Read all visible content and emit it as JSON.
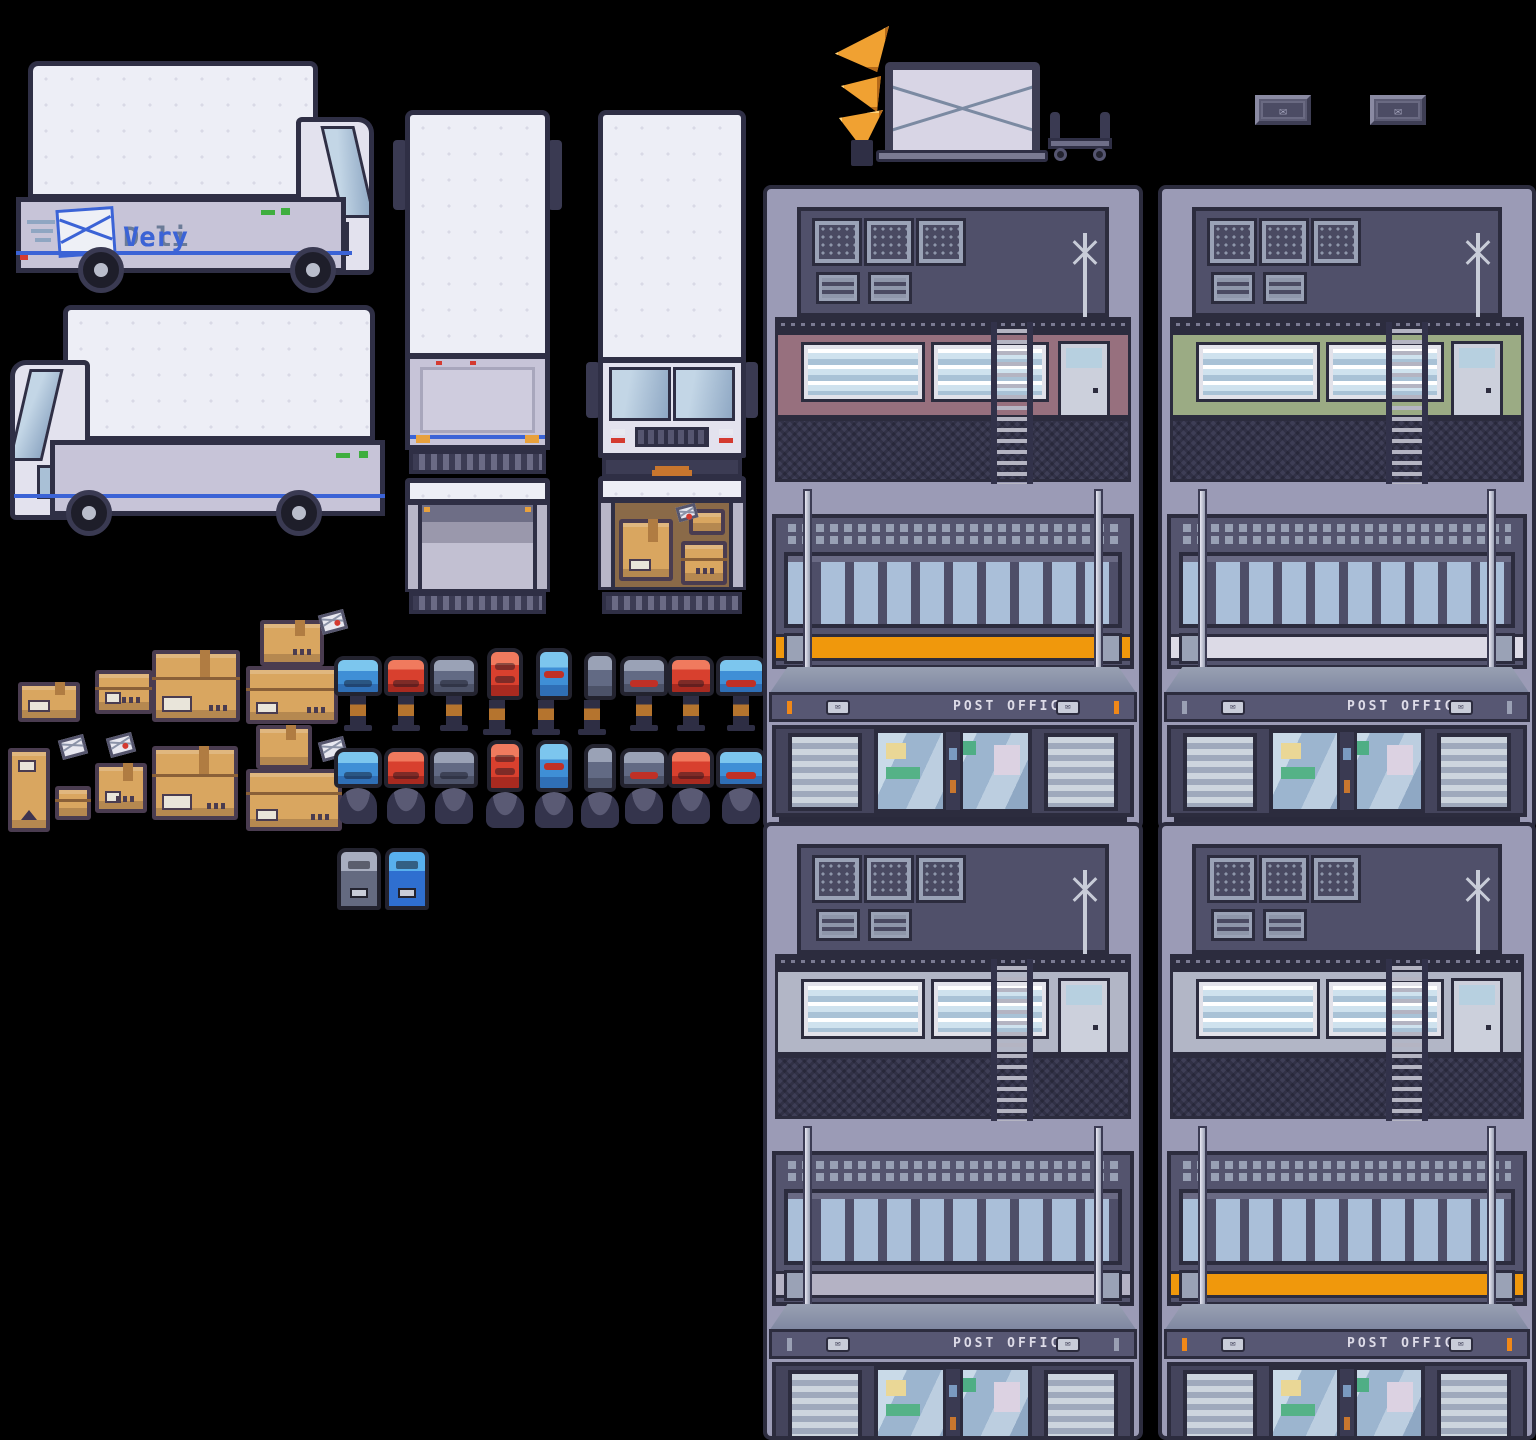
{
  "branding": {
    "logo_deli": "Deli",
    "logo_very": "Very"
  },
  "icons": {
    "envelope_glyph": "✉"
  },
  "buildings": [
    {
      "id": "post-office-top-left",
      "sign": "POST OFFICE",
      "accent": "#97707e",
      "band": "#f0980c",
      "tick": "#f08818",
      "style_vars": "--accent:#97707e;--band:#f0980c;--tick:#f08818"
    },
    {
      "id": "post-office-top-right",
      "sign": "POST OFFICE",
      "accent": "#9bab84",
      "band": "#dcdae6",
      "tick": "#9aa0b4",
      "style_vars": "--accent:#9bab84;--band:#dcdae6;--tick:#9aa0b4"
    },
    {
      "id": "post-office-bottom-left",
      "sign": "POST OFFICE",
      "accent": "#b2b6c6",
      "band": "#b4b2c4",
      "tick": "#9aa0b4",
      "style_vars": "--accent:#b2b6c6;--band:#b4b2c4;--tick:#9aa0b4"
    },
    {
      "id": "post-office-bottom-right",
      "sign": "POST OFFICE",
      "accent": "#b2b6c6",
      "band": "#f0980c",
      "tick": "#f08818",
      "style_vars": "--accent:#b2b6c6;--band:#f0980c;--tick:#f08818"
    }
  ],
  "palette": {
    "background": "#000000",
    "outline": "#2f2f45",
    "truck_white": "#edeef6",
    "truck_gray": "#c7c4d8",
    "stripe_blue": "#3b63d6",
    "logo_gray": "#6b7b97",
    "logo_blue": "#3b63d6",
    "building_wall": "#9b9bb6",
    "building_dark": "#50506a",
    "facade_dark": "#54546e",
    "accent_orange": "#f0980c",
    "accent_mauve": "#97707e",
    "accent_green": "#9bab84",
    "mailbox_blue": "#3f8fd6",
    "mailbox_red": "#d8402e",
    "mailbox_gray": "#626a84",
    "cardboard": "#d9a660",
    "cardboard_dark": "#b07c42",
    "horn_orange": "#f0a132",
    "glass_blue": "#9cb5cf"
  }
}
